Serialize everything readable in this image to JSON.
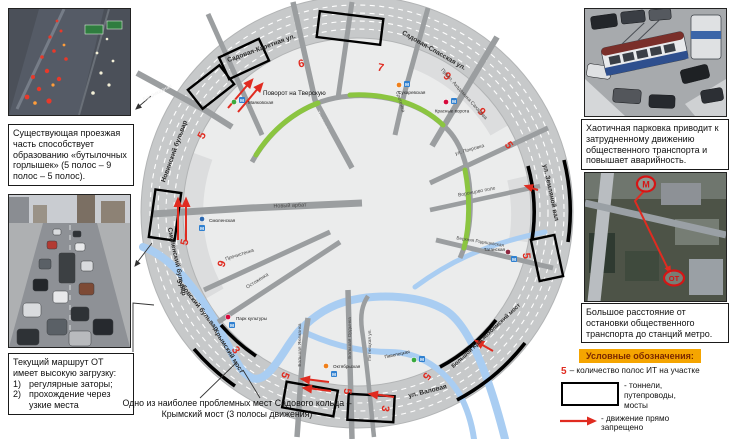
{
  "left": {
    "box_bottleneck": "Существующая проезжая часть способствует образованию «бутылочных горлышек» (5 полос – 9 полос – 5 полос).",
    "box_route": {
      "intro": "Текущий маршрут ОТ имеет высокую загрузку:",
      "items": [
        {
          "num": "1)",
          "text": "регулярные заторы;"
        },
        {
          "num": "2)",
          "text": "прохождение через узкие места"
        }
      ]
    }
  },
  "right": {
    "box_parking": "Хаотичная парковка приводит к затрудненному движению общественного транспорта и повышает аварийность.",
    "box_distance": "Большое расстояние от остановки общественного транспорта до станций метро.",
    "aerial": {
      "metro_marker": "М",
      "stop_marker": "ОТ"
    }
  },
  "legend": {
    "title": "Условные обозначения:",
    "lanes_symbol": "5",
    "lanes_text": "– количество полос ИТ на участке",
    "tunnel_text": "- тоннели,\nпутепроводы,\nмосты",
    "arrow_text": "- движение прямо\nзапрещено"
  },
  "map": {
    "caption": "Одно из наиболее проблемных мест Садового кольца – Крымский мост (3 полосы движения)",
    "turn_note": "Поворот на Тверскую",
    "metro_m": "М",
    "ring_labels": [
      "Садовая-Каретная ул.",
      "Садовая-Спасская ул.",
      "ул. Земляной вал",
      "Большой Краснохолмский мост",
      "ул. Валовая",
      "Крымский мост",
      "Зубовский бульвар",
      "Смоленский бульвар",
      "Новинский бульвар"
    ],
    "street_labels": [
      "Баррикадная",
      "Тверская",
      "Сретенка",
      "Просп. Академика Сахарова",
      "ул. Покровка",
      "Воронцово поле",
      "Верхняя Радищевская",
      "Новый арбат",
      "Пречистенка",
      "Остоженка",
      "Большая Якиманка",
      "Большая Ордынка",
      "Пятницкая ул."
    ],
    "lane_counts": [
      "5",
      "6",
      "7",
      "9",
      "9",
      "5",
      "5",
      "5",
      "3",
      "5",
      "5",
      "3",
      "9",
      "5"
    ],
    "stations": [
      {
        "name": "Маяковская",
        "line_color": "#39a93c"
      },
      {
        "name": "Сухаревская",
        "line_color": "#ef7f1a"
      },
      {
        "name": "Красные ворота",
        "line_color": "#d6083b"
      },
      {
        "name": "Таганская",
        "line_color": "#8f2840"
      },
      {
        "name": "Павелецкая",
        "line_color": "#39a93c"
      },
      {
        "name": "Октябрьская",
        "line_color": "#ef7f1a"
      },
      {
        "name": "Парк культуры",
        "line_color": "#d6083b"
      },
      {
        "name": "Смоленская",
        "line_color": "#2c68b0"
      }
    ],
    "colors": {
      "lane_number": "#e02b20",
      "restriction_arrow": "#e02b20",
      "route_highlight": "#8bc540",
      "river": "#a9cdf2",
      "ring_road": "#c7c9ca",
      "tunnel_outline": "#000000",
      "metro_square": "#2f80d0",
      "legend_header_bg": "#f5a500",
      "legend_header_text": "#7a2800"
    }
  }
}
